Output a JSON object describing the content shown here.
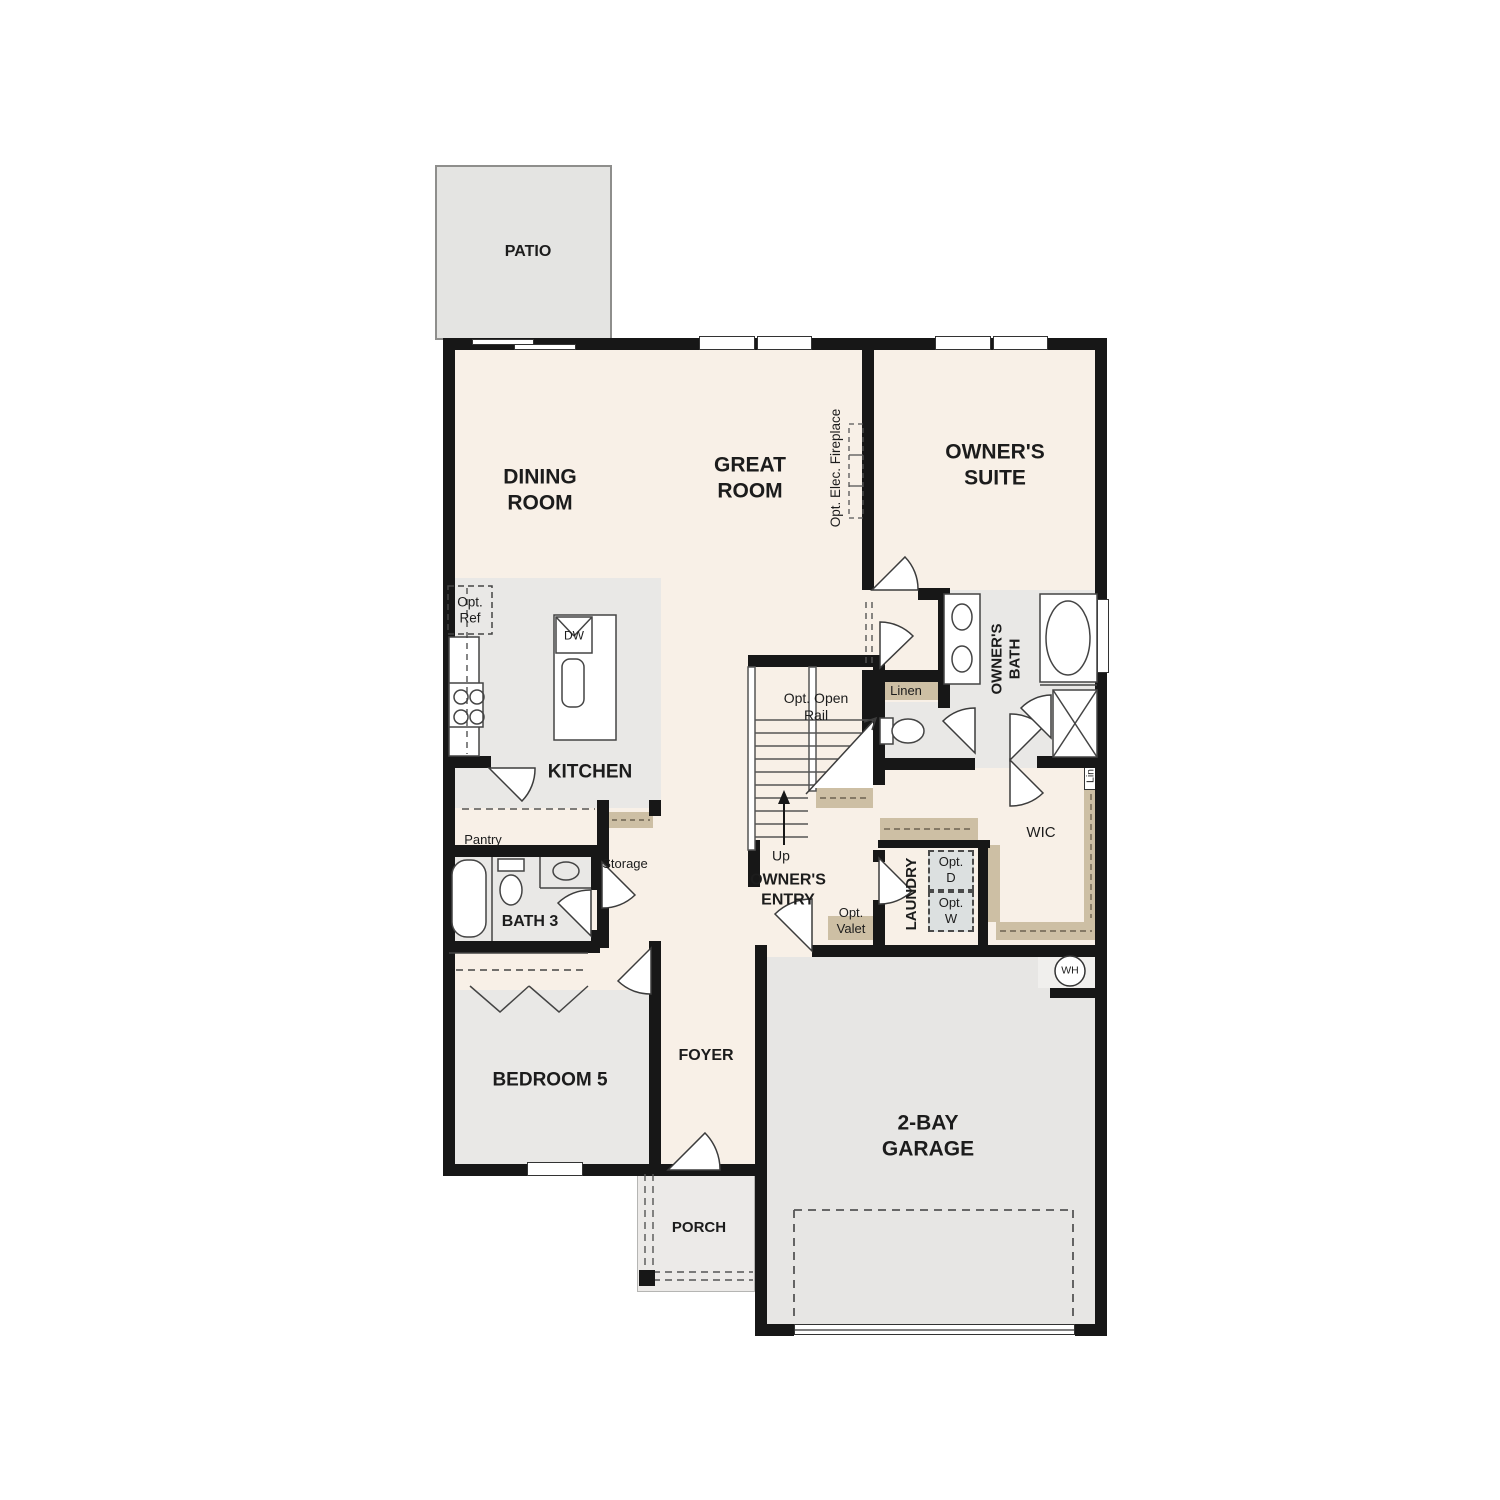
{
  "labels": {
    "patio": "PATIO",
    "dining_room": "DINING\nROOM",
    "great_room": "GREAT\nROOM",
    "owners_suite": "OWNER'S\nSUITE",
    "opt_elec_fireplace": "Opt. Elec. Fireplace",
    "opt_ref": "Opt.\nRef",
    "dw": "DW",
    "kitchen": "KITCHEN",
    "pantry": "Pantry",
    "storage": "Storage",
    "bath3": "BATH 3",
    "opt_open_rail": "Opt. Open\nRail",
    "up": "Up",
    "owners_entry": "OWNER'S\nENTRY",
    "opt_valet": "Opt.\nValet",
    "laundry": "LAUNDRY",
    "opt_d": "Opt.\nD",
    "opt_w": "Opt.\nW",
    "linen": "Linen",
    "owners_bath": "OWNER'S\nBATH",
    "lin": "Lin",
    "wic": "WIC",
    "wh": "WH",
    "bedroom5": "BEDROOM 5",
    "foyer": "FOYER",
    "porch": "PORCH",
    "garage": "2-BAY\nGARAGE"
  },
  "colors": {
    "floor_cream": "#f8f0e7",
    "floor_gray": "#e9e8e6",
    "floor_garage": "#e7e6e4",
    "floor_patio": "#e4e4e2",
    "shelf_tan": "#cdbfa4",
    "wall": "#171717",
    "appliance_fill": "#dce0e0"
  }
}
